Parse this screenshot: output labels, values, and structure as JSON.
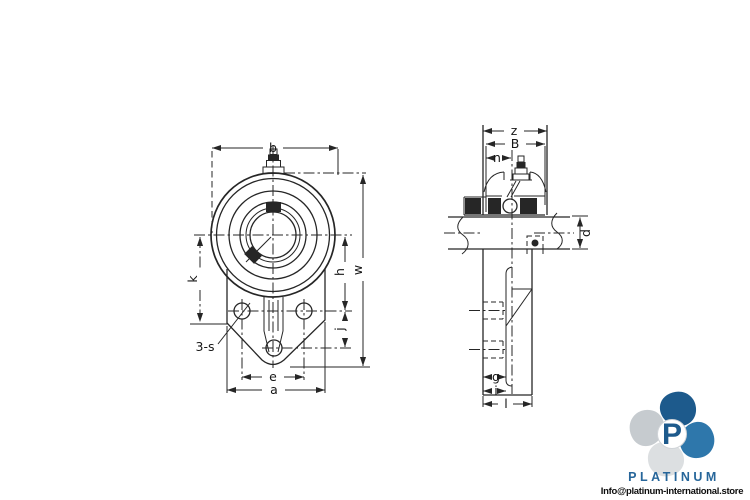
{
  "front_view": {
    "dims": {
      "b": "b",
      "w": "w",
      "h": "h",
      "j": "j",
      "k": "k",
      "s": "3-s",
      "e": "e",
      "a": "a"
    }
  },
  "side_view": {
    "dims": {
      "z": "z",
      "B": "B",
      "n": "n",
      "d": "d",
      "g": "g",
      "i": "i",
      "l": "l"
    }
  },
  "branding": {
    "monogram": "P",
    "name": "PLATINUM",
    "email": "Info@platinum-international.store",
    "colors": {
      "blue_dark": "#1d5a8c",
      "blue": "#2e77ab",
      "gray": "#c6cbcf",
      "gray_light": "#dcdfe1",
      "wordmark": "#27669a",
      "line": "#262626"
    }
  }
}
